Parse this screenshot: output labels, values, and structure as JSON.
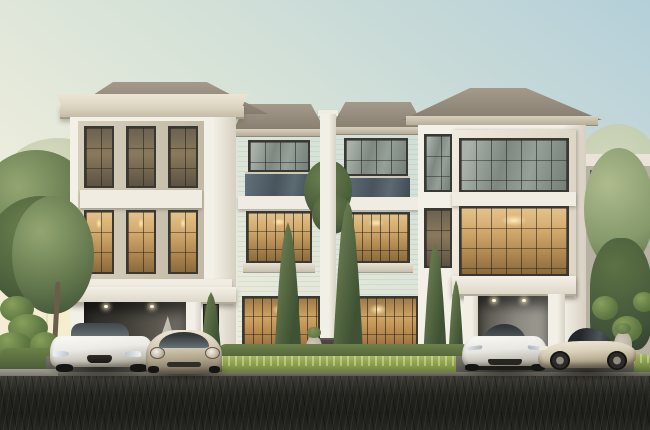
{
  "scene": {
    "title": "Luxury three-storey twin townhomes at dusk — 3D architectural rendering",
    "time_of_day": "dusk, warm interior lights on",
    "style": "modern classic white facades with hipped tan roofs",
    "buildings": {
      "left_tower": "triple-bay double-height glazed facade with amber-lit interiors, classical projecting cornice, carport below",
      "middle_units": "two mirrored wings separated by a central white pier; smoked-glass balconies, warm-lit french windows, lit ground-floor living rooms",
      "right_tower": "wide dark-framed picture windows (sky reflections above, warm light below), deep-eave hipped roof, carport below",
      "left_boundary": "low stone garden wall",
      "right_background": "neighbouring unit with white parapet and louvred screen"
    },
    "cars": [
      {
        "name": "white-sedan",
        "body_color": "#ece9e2",
        "position": "front-left driveway"
      },
      {
        "name": "champagne-coupe",
        "body_color": "#cfc5ae",
        "position": "front-left driveway"
      },
      {
        "name": "white-sports-car",
        "body_color": "#f2f1ec",
        "position": "front-right driveway"
      },
      {
        "name": "champagne-gt",
        "body_color": "#d9cfb8",
        "position": "front-right driveway"
      }
    ],
    "landscape": [
      "italian cypress columns",
      "clipped bright hedgerow",
      "cloud-pruned topiary",
      "stone urn planters",
      "mature canopy trees both edges"
    ],
    "foreground": "dark block-paved road with diagonal paver lines"
  },
  "colors": {
    "sky_top": "#b4cfd9",
    "sky_mid": "#d6e2d8",
    "sky_horizon": "#f6eed6",
    "facade_white": "#f3f0e8",
    "trim_cream": "#ddd6c3",
    "cornice_shadow": "#c4bca7",
    "roof_tan": "#a49a8a",
    "roof_dark": "#877d6f",
    "frame_dark": "#3a3833",
    "glow_bright": "#d2a86b",
    "glow_deep": "#8a6a3d",
    "glass_cool": "#7e8880",
    "balcony_glass": "#49545d",
    "cypress_dark": "#3f5233",
    "cypress_light": "#6d7f52",
    "tree_green": "#64784e",
    "tree_hazy": "#c2cba8",
    "hedge_bright": "#8fa34f",
    "hedge_dark": "#4f6336",
    "wall_stone": "#d5cec0",
    "bg_building": "#b7b1a4",
    "driveway": "#5a5852",
    "road": "#23231e",
    "carport_dark": "#3c3a34",
    "carport_light": "#8b8880",
    "car_white": "#f2f1ec",
    "car_champagne": "#d6cbb4"
  }
}
